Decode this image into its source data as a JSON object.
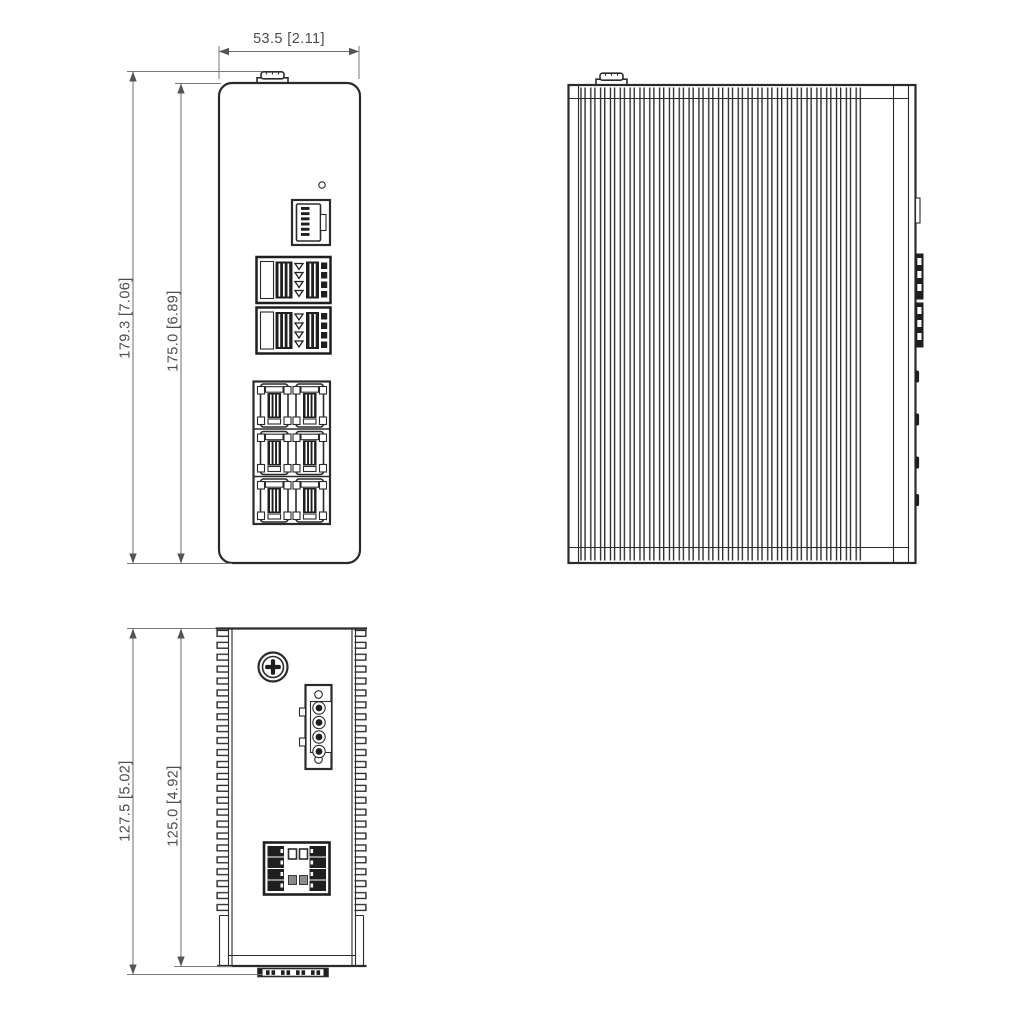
{
  "page": {
    "title": "Industrial Ethernet Switch - Dimensional Drawing",
    "background": "#ffffff"
  },
  "colors": {
    "line_dark": "#2b2b2b",
    "line_dimension": "#6e6e6e",
    "text": "#4d4d4d",
    "fill_dark": "#1f1f1f"
  },
  "views": {
    "front": {
      "name": "front-view",
      "dimensions": {
        "width": "53.5 [2.11]",
        "height_overall": "179.3 [7.06]",
        "height_body": "175.0 [6.89]"
      },
      "features": [
        "ground-stud",
        "led-hole",
        "console-rj45-port",
        "sfp-port-block-upper",
        "sfp-port-block-lower",
        "rj45-port-grid-2x3"
      ]
    },
    "side": {
      "name": "side-view",
      "features": [
        "ground-stud",
        "heatsink-fins",
        "console-port-edge",
        "sfp-cage-edges",
        "rj45-port-edges"
      ]
    },
    "top": {
      "name": "top-view",
      "dimensions": {
        "depth_overall": "127.5 [5.02]",
        "depth_body": "125.0 [4.92]"
      },
      "features": [
        "heatsink-fin-edges",
        "grounding-screw",
        "power-terminal-block-4pin",
        "io-connector-block",
        "din-rail-clip"
      ]
    }
  }
}
